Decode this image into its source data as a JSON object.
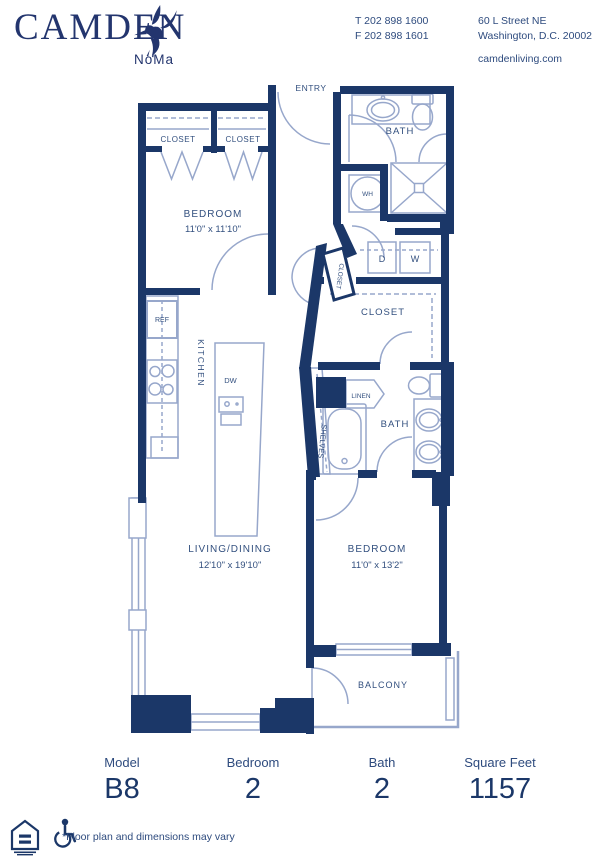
{
  "brand": {
    "name": "CAMDEN",
    "community": "NoMa"
  },
  "contact": {
    "phone_t": "T 202 898 1600",
    "phone_f": "F 202 898 1601",
    "address1": "60 L Street NE",
    "address2": "Washington, D.C. 20002",
    "website": "camdenliving.com"
  },
  "plan": {
    "entry": "ENTRY",
    "bath_upper": "BATH",
    "bath_lower": "BATH",
    "wh": "WH",
    "dryer": "D",
    "washer": "W",
    "closet_a": "CLOSET",
    "closet_b": "CLOSET",
    "closet_hall": "CLOSET",
    "closet_walkin": "CLOSET",
    "ref": "REF",
    "kitchen": "KITCHEN",
    "dw": "DW",
    "linen": "LINEN",
    "shelves": "SHELVES",
    "bedroom1_label": "BEDROOM",
    "bedroom1_dims": "11'0\" x 11'10\"",
    "bedroom2_label": "BEDROOM",
    "bedroom2_dims": "11'0\" x 13'2\"",
    "living_label": "LIVING/DINING",
    "living_dims": "12'10\" x 19'10\"",
    "balcony": "BALCONY"
  },
  "summary": {
    "model_label": "Model",
    "model_value": "B8",
    "bedroom_label": "Bedroom",
    "bedroom_value": "2",
    "bath_label": "Bath",
    "bath_value": "2",
    "sqft_label": "Square Feet",
    "sqft_value": "1157"
  },
  "footer": {
    "disclaimer": "*Floor plan and dimensions may vary"
  },
  "icons": {
    "logo": "hummingbird-icon",
    "housing": "equal-housing-icon",
    "access": "wheelchair-icon"
  },
  "colors": {
    "walls_navy": "#1b3768",
    "label_navy": "#33507f",
    "fixture_blue": "#97a7cb"
  }
}
